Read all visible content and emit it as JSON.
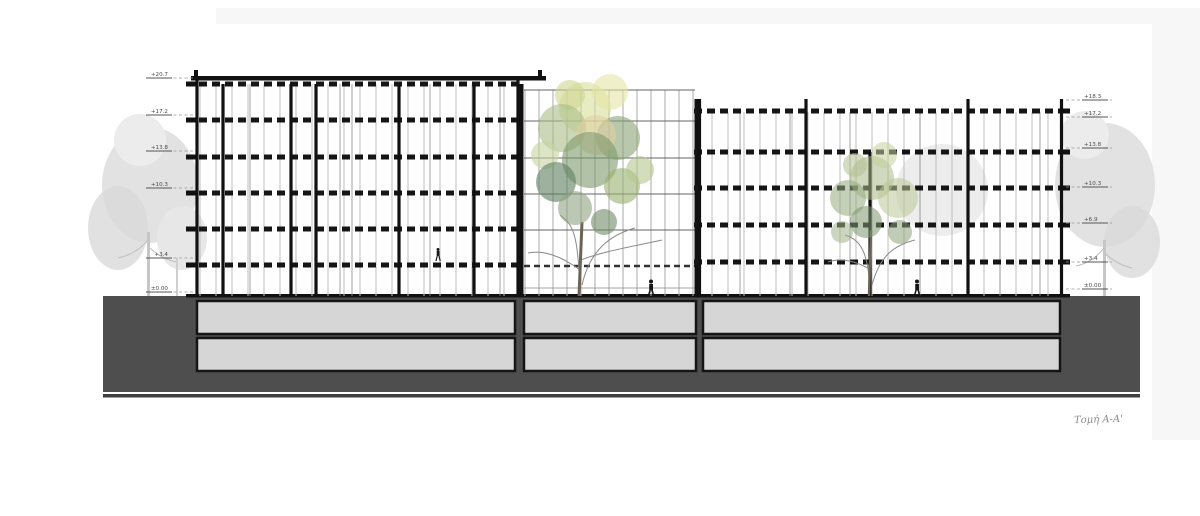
{
  "caption": "Τομή Α-Α'",
  "levels": {
    "left": [
      "+20.7",
      "+17.2",
      "+13.8",
      "+10.3",
      "+3.4",
      "±0.00"
    ],
    "right": [
      "+18.3",
      "+17.2",
      "+13.8",
      "+10.3",
      "+6.9",
      "+3.4",
      "±0.00"
    ]
  },
  "colors": {
    "margin": "#f7f7f7",
    "ground": "#4e4e4e",
    "ground_shadow": "#3f3f3f",
    "basement_fill": "#d6d6d6",
    "line": "#151515",
    "annotation": "#4a4a4a",
    "bg_foliage": "#e2e2e2",
    "foliage_light": "#d9df9b",
    "foliage_mid": "#8fa874",
    "foliage_dark": "#5d7d5f"
  }
}
